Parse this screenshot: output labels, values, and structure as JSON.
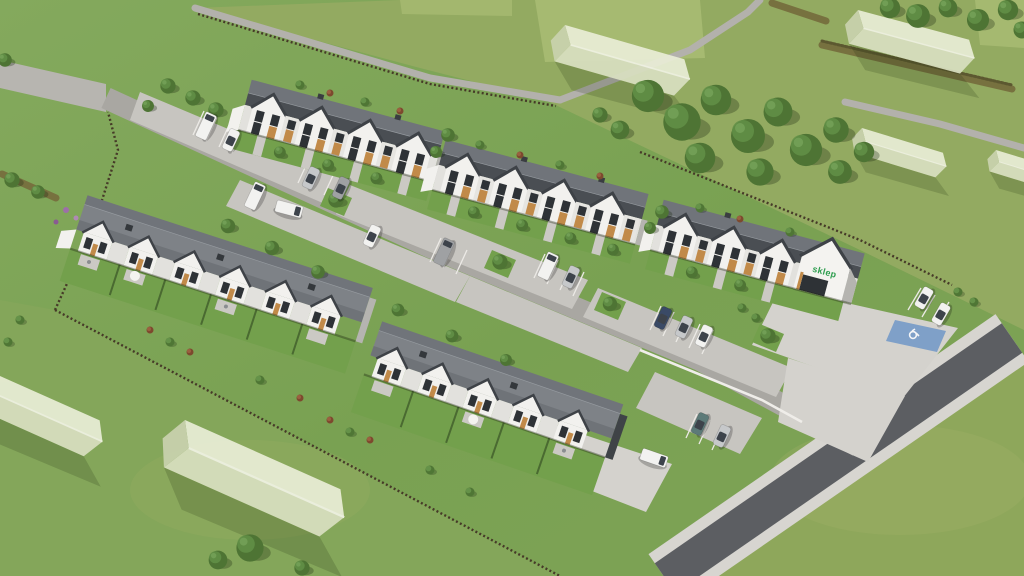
{
  "scene": {
    "description": "Aerial 3D visualization of a suburban townhouse estate with parking, shop, roads and future ghost houses",
    "shop_sign_label": "sklep",
    "shop_sign_color": "#2f9e50",
    "accessible_parking_color": "#7fa0c8",
    "accessible_parking_icon": "wheelchair-icon"
  },
  "palette": {
    "grass": "#7ca355",
    "field": "#93aa61",
    "field_light": "#b7c77f",
    "road_concrete": "#c7c5c0",
    "street_gray": "#a9a7a2",
    "plaza": "#d4d2cd",
    "asphalt": "#5c5e62",
    "sidewalk": "#d7d5d0",
    "roof_dark": "#4a4e53",
    "roof_light": "#7e8287",
    "wall_white": "#f2f1ee",
    "wood_accent": "#c18a49",
    "window_dark": "#2e3236",
    "tree_green": "#4e7434",
    "hedge_brown": "#77713f",
    "ghost_house": "#dde4c6",
    "fence_brown": "#463a28",
    "car_white": "#f2f2f0",
    "car_silver": "#c6c8ca",
    "car_gray": "#9fa1a3",
    "car_darkblue": "#3a4a66",
    "car_teal": "#5c7a78"
  },
  "objects": {
    "street_facing_rows": 3,
    "garden_wings": 2,
    "shop_buildings": 1,
    "ghost_houses": 6,
    "cars_visible": 18
  }
}
